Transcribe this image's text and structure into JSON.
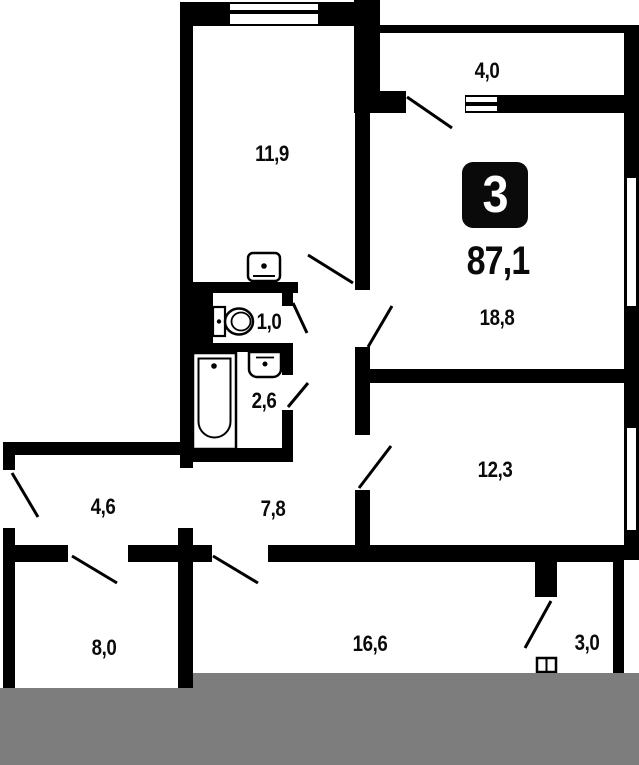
{
  "plan": {
    "badge": "3",
    "total_area": "87,1",
    "rooms": [
      {
        "area": "11,9"
      },
      {
        "area": "4,0"
      },
      {
        "area": "18,8"
      },
      {
        "area": "1,0"
      },
      {
        "area": "2,6"
      },
      {
        "area": "12,3"
      },
      {
        "area": "4,6"
      },
      {
        "area": "7,8"
      },
      {
        "area": "8,0"
      },
      {
        "area": "16,6"
      },
      {
        "area": "3,0"
      }
    ],
    "colors": {
      "wall": "#000000",
      "background": "#ffffff",
      "crop_bar": "#7d7d7d"
    }
  }
}
